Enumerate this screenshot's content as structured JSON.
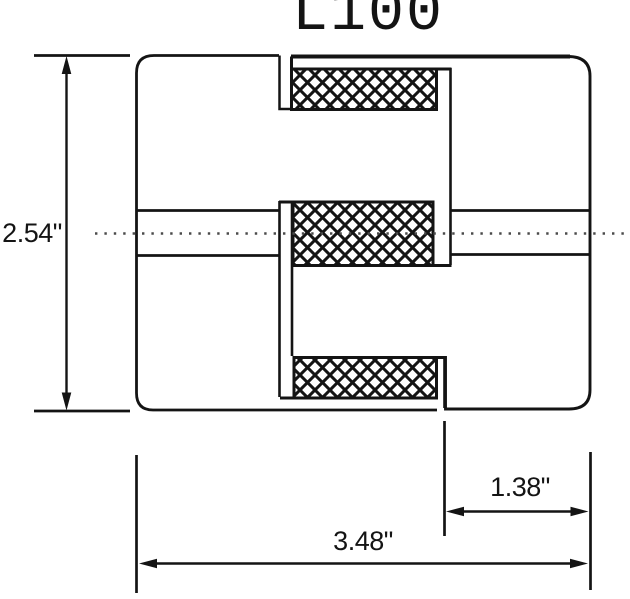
{
  "title": "L100",
  "dimensions": {
    "height": "2.54\"",
    "overall_length": "3.48\"",
    "hub_length": "1.38\""
  },
  "style": {
    "line_color": "#141414",
    "background": "#ffffff",
    "spider_fill": "crosshatch-pattern"
  }
}
